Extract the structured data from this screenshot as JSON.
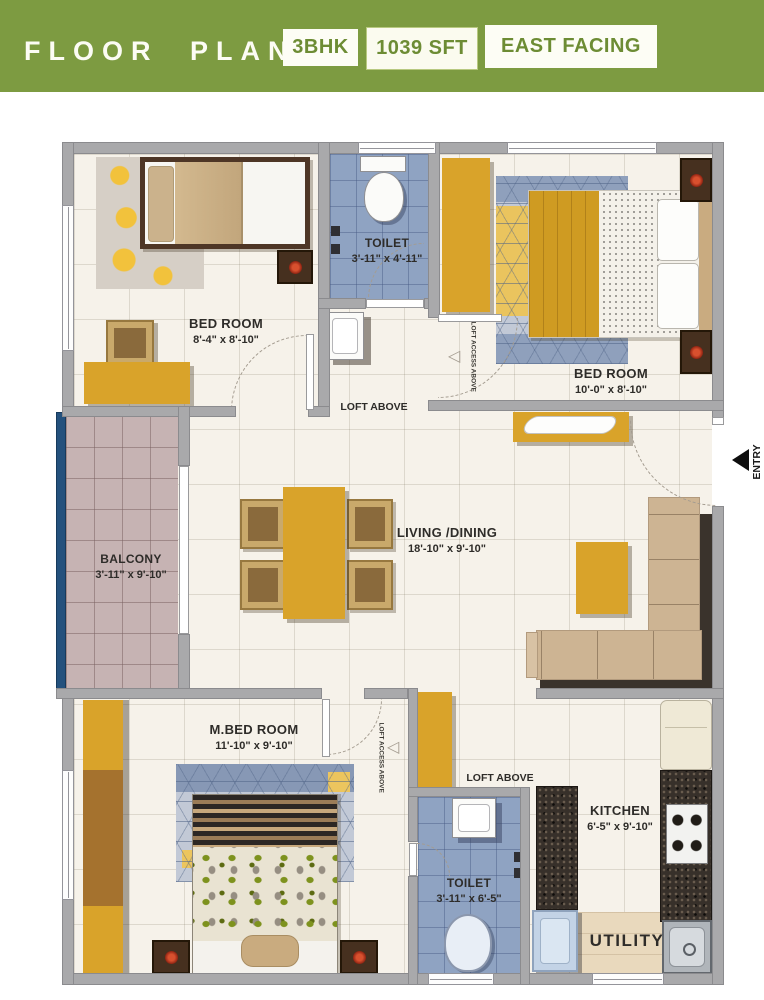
{
  "header": {
    "title": "FLOOR PLAN",
    "badges": [
      {
        "label": "3BHK"
      },
      {
        "label": "1039 SFT"
      },
      {
        "label": "EAST FACING"
      }
    ]
  },
  "rooms": {
    "bedroom1": {
      "name": "BED ROOM",
      "dims": "8'-4\" x 8'-10\""
    },
    "toilet1": {
      "name": "TOILET",
      "dims": "3'-11\" x 4'-11\""
    },
    "bedroom2": {
      "name": "BED ROOM",
      "dims": "10'-0\" x 8'-10\""
    },
    "balcony": {
      "name": "BALCONY",
      "dims": "3'-11\" x 9'-10\""
    },
    "living_dining": {
      "name": "LIVING /DINING",
      "dims": "18'-10\" x 9'-10\""
    },
    "master_bedroom": {
      "name": "M.BED ROOM",
      "dims": "11'-10\" x 9'-10\""
    },
    "toilet2": {
      "name": "TOILET",
      "dims": "3'-11\" x 6'-5\""
    },
    "kitchen": {
      "name": "KITCHEN",
      "dims": "6'-5\" x 9'-10\""
    },
    "utility": {
      "name": "UTILITY"
    }
  },
  "annotations": {
    "loft_above": "LOFT ABOVE",
    "loft_access_above": "LOFT ACCESS ABOVE",
    "entry": "ENTRY"
  },
  "colors": {
    "accent_green": "#7d9b41",
    "badge_text_green": "#6d8c34",
    "wall_gray": "#a9a9ab",
    "floor_cream": "#f6f2ea",
    "tile_blue": "#8fa3c2",
    "balcony_pink": "#c6b3b3",
    "railing_blue": "#24517d",
    "furniture_mustard": "#d9a32a",
    "sofa_tan": "#cdb493",
    "counter_granite": "#37302a",
    "utility_beige": "#e9d9bd",
    "label_dark": "#2e2c29"
  }
}
